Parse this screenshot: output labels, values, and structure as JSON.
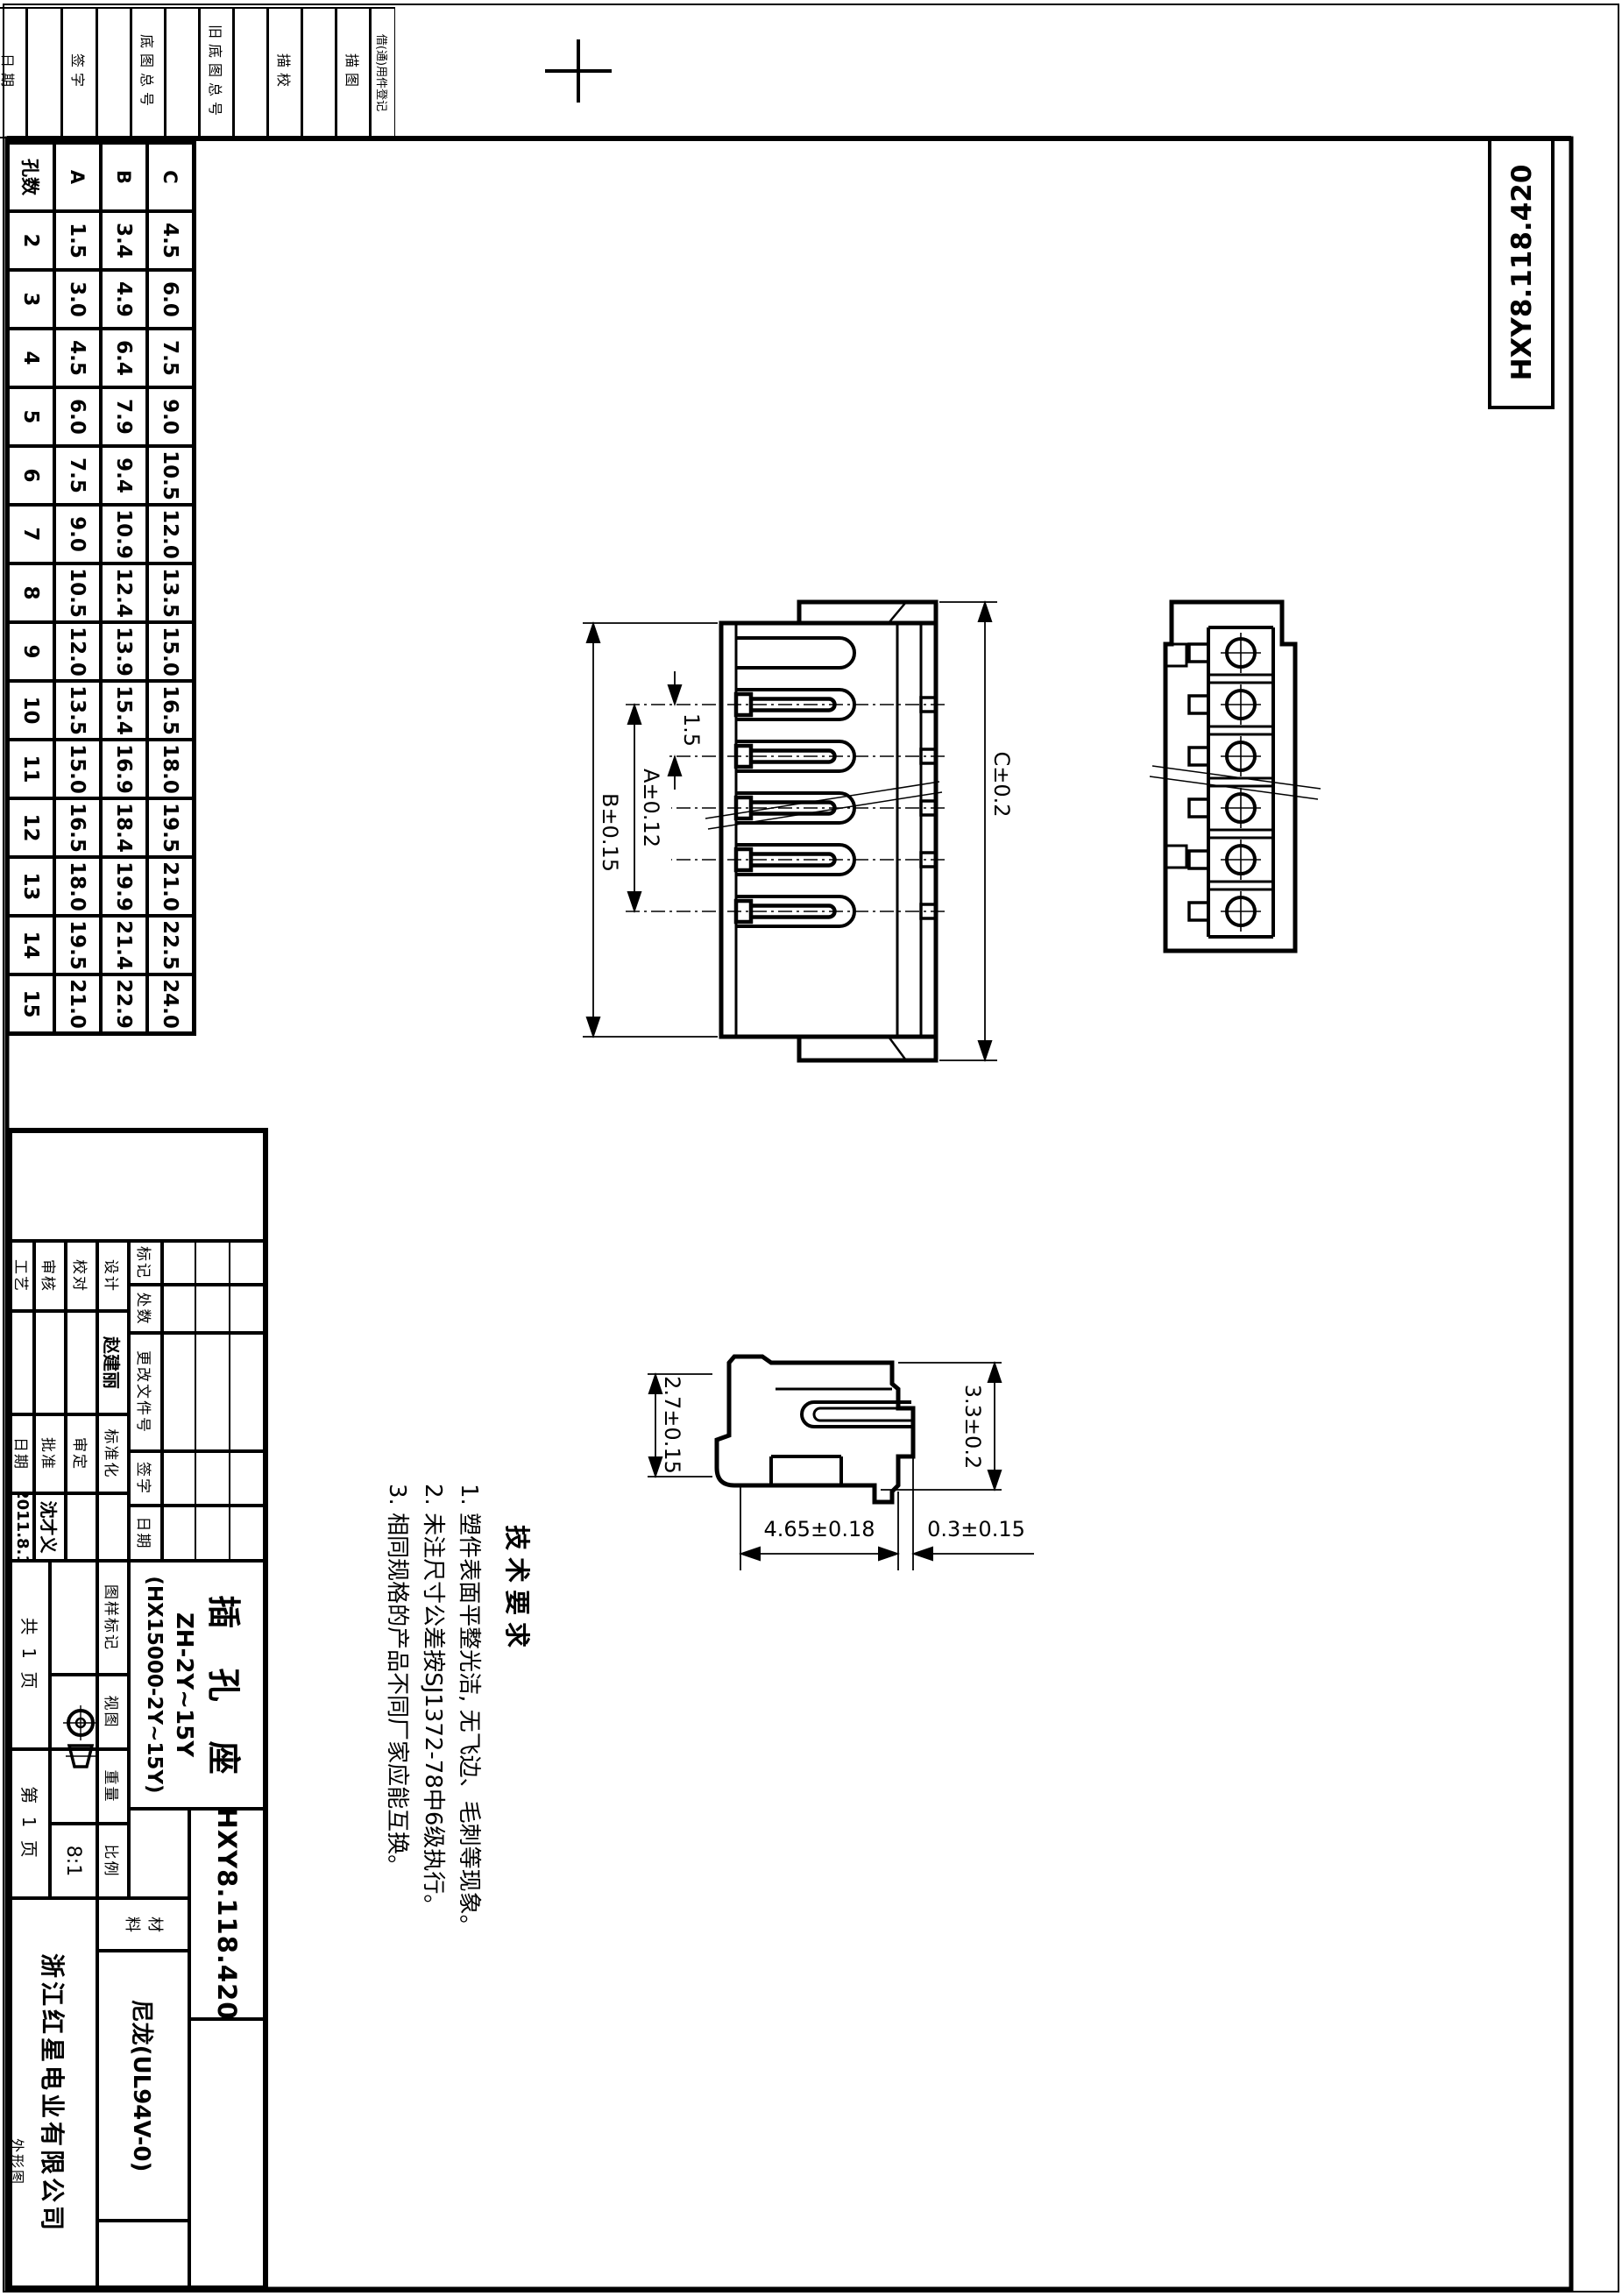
{
  "sheet": {
    "drawing_number": "HXY8.118.420",
    "part_name": "插 孔 座",
    "model": "ZH-2Y~15Y",
    "model_alt": "(HX15000-2Y~15Y)",
    "company": "浙江红星电业有限公司",
    "material_label_top": "材",
    "material_label_bottom": "料",
    "material": "尼龙(UL94V-0)",
    "scale": "8:1",
    "sheet_note": "外形图",
    "pages_total": "共 1 页",
    "page_no": "第 1 页"
  },
  "margin_fields": [
    "日期",
    "签字",
    "底图总号",
    "旧底图总号",
    "描校",
    "描图",
    "借(通)用件登记"
  ],
  "revision_header": [
    "标记",
    "处数",
    "更改文件号",
    "签字",
    "日期"
  ],
  "signature_rows": [
    [
      "设计",
      "赵建丽",
      "标准化",
      ""
    ],
    [
      "校对",
      "",
      "审定",
      ""
    ],
    [
      "审核",
      "",
      "批准",
      "沈才义"
    ],
    [
      "工艺",
      "",
      "日期",
      "2011.8.1"
    ]
  ],
  "spec_labels": [
    "图样标记",
    "视图",
    "重量",
    "比例"
  ],
  "tech_requirements": {
    "title": "技术要求",
    "items": [
      "1. 塑件表面平整光洁, 无飞边、毛刺等现象。",
      "2. 未注尺寸公差按SJ1372-78中6级执行。",
      "3. 相同规格的产品不同厂家应能互换。"
    ]
  },
  "dimensions": {
    "pitch": "1.5",
    "a": "A±0.12",
    "b": "B±0.15",
    "c": "C±0.2",
    "h_left": "2.7±0.15",
    "h_right": "3.3±0.2",
    "height": "4.65±0.18",
    "standoff": "0.3±0.15"
  },
  "dim_table": {
    "col_headers": [
      "孔数",
      "A",
      "B",
      "C"
    ],
    "rows": [
      [
        "2",
        "1.5",
        "3.4",
        "4.5"
      ],
      [
        "3",
        "3.0",
        "4.9",
        "6.0"
      ],
      [
        "4",
        "4.5",
        "6.4",
        "7.5"
      ],
      [
        "5",
        "6.0",
        "7.9",
        "9.0"
      ],
      [
        "6",
        "7.5",
        "9.4",
        "10.5"
      ],
      [
        "7",
        "9.0",
        "10.9",
        "12.0"
      ],
      [
        "8",
        "10.5",
        "12.4",
        "13.5"
      ],
      [
        "9",
        "12.0",
        "13.9",
        "15.0"
      ],
      [
        "10",
        "13.5",
        "15.4",
        "16.5"
      ],
      [
        "11",
        "15.0",
        "16.9",
        "18.0"
      ],
      [
        "12",
        "16.5",
        "18.4",
        "19.5"
      ],
      [
        "13",
        "18.0",
        "19.9",
        "21.0"
      ],
      [
        "14",
        "19.5",
        "21.4",
        "22.5"
      ],
      [
        "15",
        "21.0",
        "22.9",
        "24.0"
      ]
    ]
  }
}
